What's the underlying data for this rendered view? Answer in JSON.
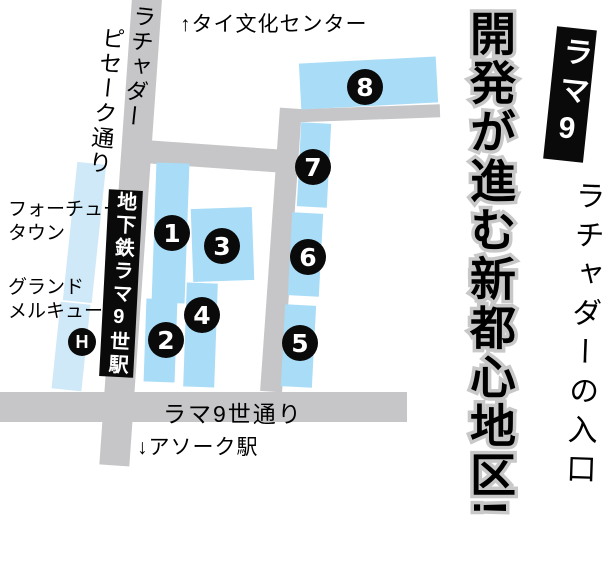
{
  "colors": {
    "block_blue": "#a9dcf7",
    "pale_blue": "#cfe9f8",
    "road_gray": "#c6c6c8",
    "ink": "#0a0a0a",
    "headline_outline": "#c8c8c8"
  },
  "map": {
    "top_destination": "↑タイ文化センター",
    "street_vertical": "ラチャダー\n　ピセーク通り",
    "station": "地下鉄ラマ9世駅",
    "fortune_town": "フォーチューン\nタウン",
    "grand_mercure": "グランド\nメルキュール",
    "hotel_marker": "H",
    "rama9_road": "ラマ9世通り",
    "bottom_destination": "↓アソーク駅",
    "markers": [
      "1",
      "2",
      "3",
      "4",
      "5",
      "6",
      "7",
      "8"
    ]
  },
  "panel": {
    "badge": "ラマ9",
    "subtitle": "ラチャダーの入口",
    "headline": "開発が進む新都心地区!"
  }
}
